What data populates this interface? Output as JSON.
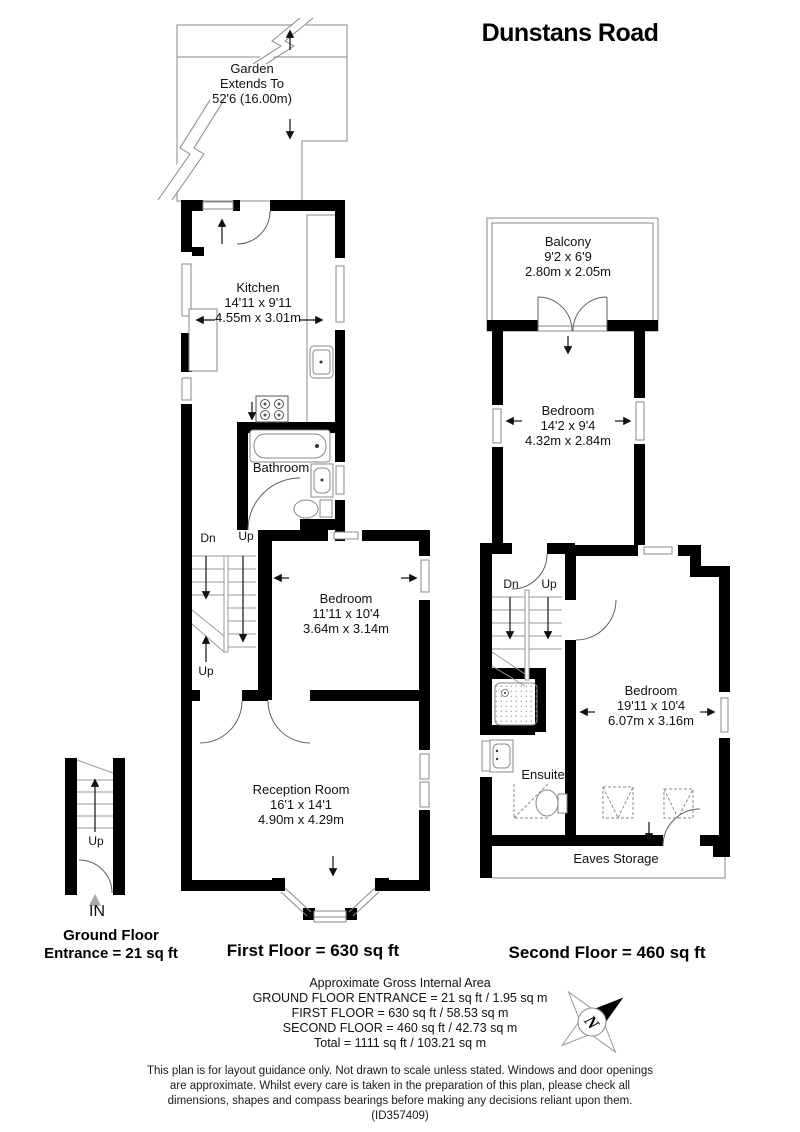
{
  "title": "Dunstans Road",
  "garden": {
    "name": "Garden",
    "line2": "Extends To",
    "line3": "52'6 (16.00m)"
  },
  "first_floor": {
    "caption": "First Floor = 630 sq ft",
    "kitchen": {
      "name": "Kitchen",
      "dims_ft": "14'11 x 9'11",
      "dims_m": "4.55m x 3.01m"
    },
    "bathroom": {
      "name": "Bathroom"
    },
    "bedroom": {
      "name": "Bedroom",
      "dims_ft": "11'11 x 10'4",
      "dims_m": "3.64m x 3.14m"
    },
    "reception": {
      "name": "Reception Room",
      "dims_ft": "16'1 x 14'1",
      "dims_m": "4.90m x 4.29m"
    },
    "stairs": {
      "down_label": "Dn",
      "up_label": "Up",
      "up_label_bottom": "Up"
    }
  },
  "ground_floor": {
    "caption_line1": "Ground Floor",
    "caption_line2": "Entrance = 21 sq ft",
    "stairs_up_label": "Up",
    "entry_label": "IN"
  },
  "second_floor": {
    "caption": "Second Floor = 460 sq ft",
    "balcony": {
      "name": "Balcony",
      "dims_ft": "9'2 x 6'9",
      "dims_m": "2.80m x 2.05m"
    },
    "bedroom_front": {
      "name": "Bedroom",
      "dims_ft": "14'2 x 9'4",
      "dims_m": "4.32m x 2.84m"
    },
    "bedroom_rear": {
      "name": "Bedroom",
      "dims_ft": "19'11 x 10'4",
      "dims_m": "6.07m x 3.16m"
    },
    "ensuite": {
      "name": "Ensuite"
    },
    "eaves_storage": {
      "name": "Eaves Storage"
    },
    "stairs": {
      "down_label": "Dn",
      "up_label": "Up"
    }
  },
  "summary": {
    "heading": "Approximate Gross Internal Area",
    "lines": [
      "GROUND FLOOR ENTRANCE = 21 sq ft / 1.95 sq m",
      "FIRST FLOOR = 630 sq ft / 58.53 sq m",
      "SECOND FLOOR = 460 sq ft / 42.73 sq m",
      "Total = 1111 sq ft / 103.21 sq m"
    ]
  },
  "compass": {
    "north_label": "N"
  },
  "disclaimer": "This plan is for layout guidance only. Not drawn to scale unless stated. Windows and door openings are approximate. Whilst every care is taken in the preparation of this plan, please check all dimensions, shapes and compass bearings before making any decisions reliant upon them. (ID357409)",
  "colors": {
    "wall": "#000000",
    "thin_line": "#888888",
    "door_arc": "#606060",
    "text": "#111111"
  }
}
